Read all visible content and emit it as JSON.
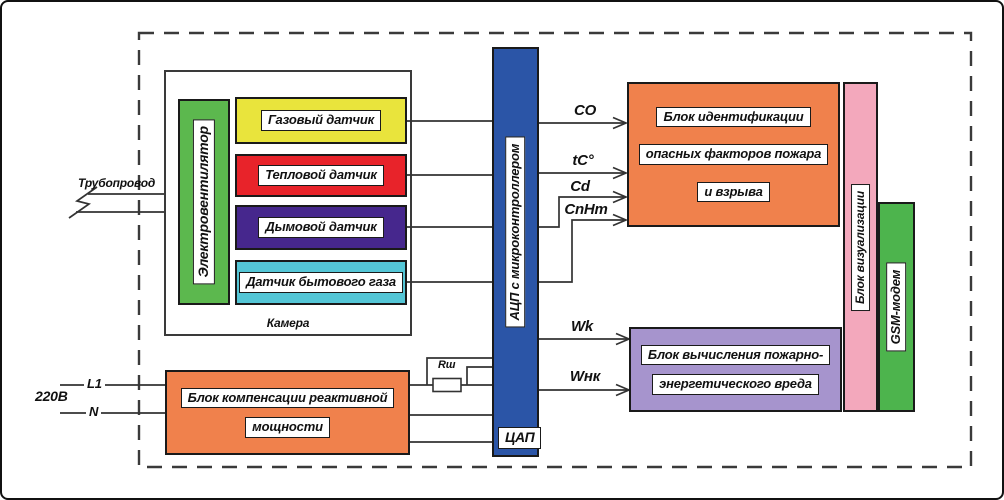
{
  "pipeline": {
    "label": "Трубопровод"
  },
  "power": {
    "voltage": "220В",
    "line1": "L1",
    "neutral": "N"
  },
  "camera": {
    "label": "Камера",
    "fan_label": "Электровентилятор",
    "sensors": [
      {
        "label": "Газовый датчик"
      },
      {
        "label": "Тепловой датчик"
      },
      {
        "label": "Дымовой датчик"
      },
      {
        "label": "Датчик бытового газа"
      }
    ]
  },
  "adc": {
    "label": "АЦП с микроконтроллером",
    "dac_label": "ЦАП"
  },
  "shunt": {
    "label": "Rш"
  },
  "signals": {
    "co": "CO",
    "temp": "tC°",
    "cd": "Cd",
    "cnhm": "CnHm",
    "wk": "Wk",
    "wnk": "Wнк"
  },
  "ident_block": {
    "line1": "Блок идентификации",
    "line2": "опасных факторов пожара",
    "line3": "и взрыва"
  },
  "calc_block": {
    "line1": "Блок вычисления пожарно-",
    "line2": "энергетического вреда"
  },
  "viz_block": {
    "label": "Блок визуализации"
  },
  "gsm_block": {
    "label": "GSM-модем"
  },
  "comp_block": {
    "line1": "Блок компенсации реактивной",
    "line2": "мощности"
  },
  "colors": {
    "fan_green": "#5cb84e",
    "gas_yellow": "#e9e43c",
    "heat_red": "#e8232a",
    "smoke_purple": "#46278d",
    "household_cyan": "#54c6d6",
    "adc_blue": "#2b55a7",
    "ident_orange": "#f0814c",
    "viz_pink": "#f3a8bc",
    "gsm_green": "#4db44d",
    "calc_lavender": "#a694cd",
    "comp_orange": "#f0814c"
  }
}
